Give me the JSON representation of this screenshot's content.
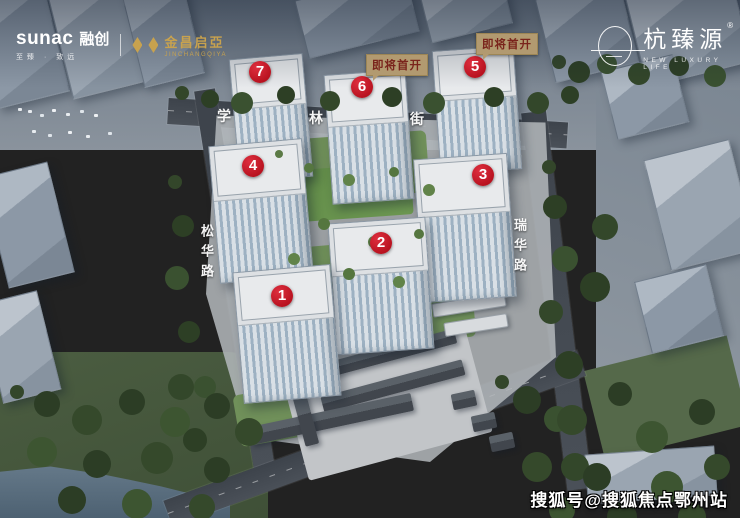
{
  "branding": {
    "sunac_latin": "sunac",
    "sunac_cn": "融创",
    "sunac_slogan": "至臻 · 致远",
    "partner_cn": "金昌启亞",
    "partner_latin": "JINCHANGQIYA",
    "project_name": "杭臻源",
    "project_reg": "®",
    "project_tagline": "NEW LUXURY LIFE"
  },
  "map": {
    "building_markers": [
      {
        "num": "1",
        "x": 282,
        "y": 296
      },
      {
        "num": "2",
        "x": 381,
        "y": 243
      },
      {
        "num": "3",
        "x": 483,
        "y": 175
      },
      {
        "num": "4",
        "x": 253,
        "y": 166
      },
      {
        "num": "5",
        "x": 475,
        "y": 67
      },
      {
        "num": "6",
        "x": 362,
        "y": 87
      },
      {
        "num": "7",
        "x": 260,
        "y": 72
      }
    ],
    "coming_soon_badges": [
      {
        "label": "即将首开",
        "for_building": "6",
        "x": 366,
        "y": 54
      },
      {
        "label": "即将首开",
        "for_building": "5",
        "x": 476,
        "y": 33
      }
    ],
    "streets": [
      {
        "name": "学林街",
        "orientation": "horizontal",
        "chars": [
          {
            "ch": "学",
            "x": 225,
            "y": 116
          },
          {
            "ch": "林",
            "x": 317,
            "y": 118
          },
          {
            "ch": "街",
            "x": 418,
            "y": 119
          }
        ]
      },
      {
        "name": "松华路",
        "orientation": "vertical",
        "x": 197,
        "y": 224
      },
      {
        "name": "瑞华路",
        "orientation": "vertical",
        "x": 510,
        "y": 218
      }
    ]
  },
  "watermark": {
    "text": "搜狐号@搜狐焦点鄂州站"
  },
  "colors": {
    "marker_red": "#b8121f",
    "coming_soon_bg": "#b29a70",
    "coming_soon_text": "#7a241c",
    "brand_gold": "#c8a24e",
    "street_label": "#ffffff"
  }
}
